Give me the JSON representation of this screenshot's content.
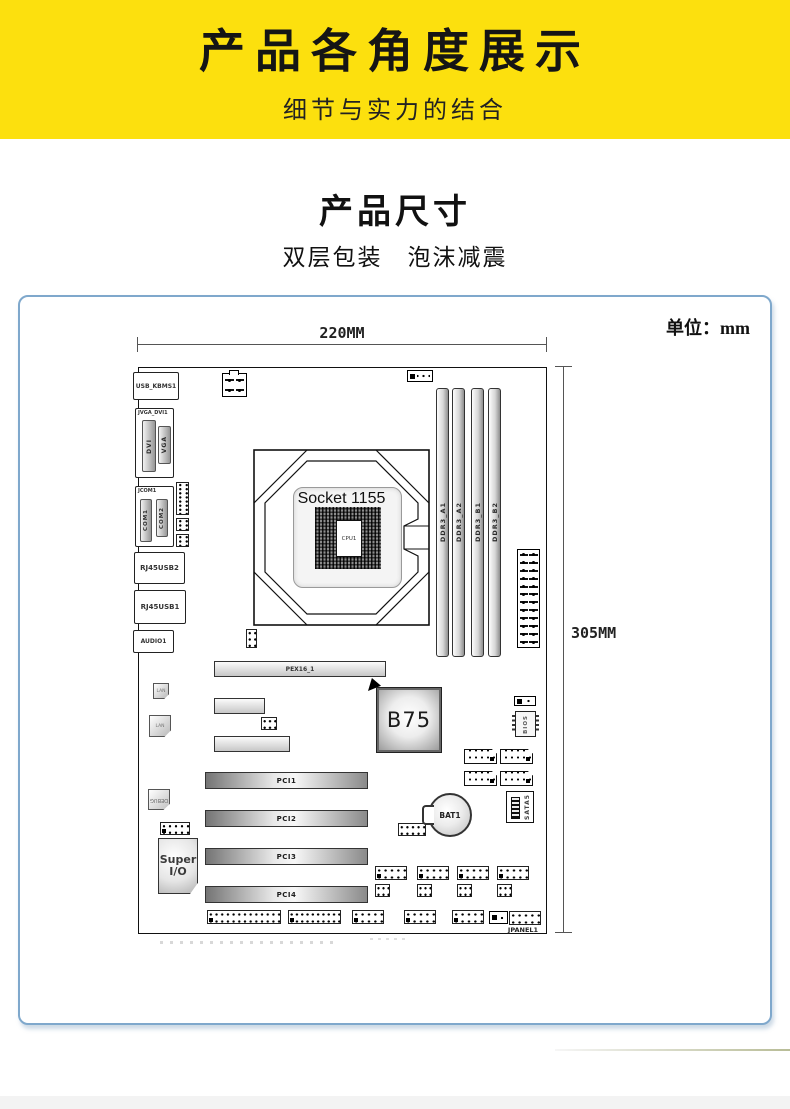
{
  "banner": {
    "title": "产品各角度展示",
    "subtitle": "细节与实力的结合",
    "bg_color": "#FCE00E"
  },
  "section": {
    "title": "产品尺寸",
    "subtitle": "双层包装　泡沫减震"
  },
  "diagram": {
    "unit_label": "单位：mm",
    "width_label": "220MM",
    "height_label": "305MM",
    "frame_border_color": "#7FA8CC",
    "socket": {
      "title": "Socket 1155",
      "cpu": "CPU1"
    }
  },
  "board": {
    "components": [
      {
        "t": "block",
        "n": "usb-kbms1-port",
        "l": "USB_KBMS1",
        "x": 133,
        "y": 372,
        "w": 46,
        "h": 28,
        "fs": 6
      },
      {
        "t": "blockTop",
        "n": "jvga-dvi1-block",
        "l": "JVGA_DVI1",
        "x": 135,
        "y": 408,
        "w": 39,
        "h": 70,
        "fs": 5
      },
      {
        "t": "gslotv",
        "n": "dvi-port",
        "l": "DVI",
        "x": 142,
        "y": 420,
        "w": 14,
        "h": 52,
        "fs": 6
      },
      {
        "t": "gslotv",
        "n": "vga-port",
        "l": "VGA",
        "x": 158,
        "y": 426,
        "w": 13,
        "h": 38,
        "fs": 6
      },
      {
        "t": "blockTop",
        "n": "jcom1-block",
        "l": "JCOM1",
        "x": 135,
        "y": 486,
        "w": 39,
        "h": 61,
        "fs": 6
      },
      {
        "t": "gslotv",
        "n": "com1-port",
        "l": "COM1",
        "x": 140,
        "y": 499,
        "w": 12,
        "h": 43,
        "fs": 5.5
      },
      {
        "t": "gslotv",
        "n": "com2-port",
        "l": "COM2",
        "x": 156,
        "y": 499,
        "w": 12,
        "h": 38,
        "fs": 5.5
      },
      {
        "t": "header",
        "n": "com-pin-header-1",
        "x": 176,
        "y": 482,
        "w": 13,
        "h": 33,
        "c": 2,
        "r": 8
      },
      {
        "t": "header",
        "n": "com-pin-header-2",
        "x": 176,
        "y": 518,
        "w": 13,
        "h": 13,
        "c": 2,
        "r": 3
      },
      {
        "t": "header",
        "n": "com-pin-header-3",
        "x": 176,
        "y": 534,
        "w": 13,
        "h": 13,
        "c": 2,
        "r": 3
      },
      {
        "t": "block",
        "n": "rj45usb2-port",
        "l": "RJ45USB2",
        "x": 134,
        "y": 552,
        "w": 51,
        "h": 32,
        "fs": 7
      },
      {
        "t": "block",
        "n": "rj45usb1-port",
        "l": "RJ45USB1",
        "x": 134,
        "y": 590,
        "w": 52,
        "h": 34,
        "fs": 7
      },
      {
        "t": "block",
        "n": "audio1-port",
        "l": "AUDIO1",
        "x": 133,
        "y": 630,
        "w": 41,
        "h": 23,
        "fs": 6
      },
      {
        "t": "power4",
        "n": "atx12v-connector",
        "x": 222,
        "y": 373,
        "w": 25,
        "h": 24
      },
      {
        "t": "fanheader",
        "n": "cpu-fan-header",
        "x": 407,
        "y": 370,
        "w": 26,
        "h": 12
      },
      {
        "t": "vslot",
        "n": "ddr3-a1-slot",
        "l": "DDR3_A1",
        "x": 436,
        "y": 388,
        "w": 13,
        "h": 269
      },
      {
        "t": "vslot",
        "n": "ddr3-a2-slot",
        "l": "DDR3_A2",
        "x": 452,
        "y": 388,
        "w": 13,
        "h": 269
      },
      {
        "t": "vslot",
        "n": "ddr3-b1-slot",
        "l": "DDR3_B1",
        "x": 471,
        "y": 388,
        "w": 13,
        "h": 269
      },
      {
        "t": "vslot",
        "n": "ddr3-b2-slot",
        "l": "DDR3_B2",
        "x": 488,
        "y": 388,
        "w": 13,
        "h": 269
      },
      {
        "t": "atx24",
        "n": "atx-24pin-connector",
        "x": 517,
        "y": 549,
        "w": 23,
        "h": 99
      },
      {
        "t": "header",
        "n": "header-under-socket",
        "x": 246,
        "y": 629,
        "w": 11,
        "h": 19,
        "c": 2,
        "r": 3
      },
      {
        "t": "hslot",
        "n": "pex16-slot",
        "l": "PEX16_1",
        "x": 214,
        "y": 661,
        "w": 172,
        "h": 16,
        "fs": 6
      },
      {
        "t": "lan",
        "n": "lan-chip-1",
        "l": "LAN",
        "x": 153,
        "y": 683,
        "w": 16,
        "h": 16
      },
      {
        "t": "lan",
        "n": "lan-chip-2",
        "l": "LAN",
        "x": 149,
        "y": 715,
        "w": 22,
        "h": 22
      },
      {
        "t": "hslot",
        "n": "pcie-x1-slot-1",
        "l": "",
        "x": 214,
        "y": 698,
        "w": 51,
        "h": 16
      },
      {
        "t": "header",
        "n": "mid-pin-header",
        "x": 261,
        "y": 717,
        "w": 16,
        "h": 13,
        "c": 3,
        "r": 2
      },
      {
        "t": "hslot",
        "n": "pcie-x1-slot-2",
        "l": "",
        "x": 214,
        "y": 736,
        "w": 76,
        "h": 16
      },
      {
        "t": "marker",
        "n": "b75-arrow-marker",
        "x": 368,
        "y": 678,
        "w": 13,
        "h": 13
      },
      {
        "t": "b75",
        "n": "b75-chipset",
        "l": "B75",
        "x": 377,
        "y": 688,
        "w": 64,
        "h": 64,
        "fs": 21
      },
      {
        "t": "fanheader",
        "n": "sys-fan-header",
        "x": 514,
        "y": 696,
        "w": 22,
        "h": 10
      },
      {
        "t": "bios",
        "n": "bios-chip",
        "l": "BIOS",
        "x": 515,
        "y": 711,
        "w": 21,
        "h": 26
      },
      {
        "t": "sata",
        "n": "sata-port-1",
        "x": 464,
        "y": 749,
        "w": 33,
        "h": 15
      },
      {
        "t": "sata",
        "n": "sata-port-2",
        "x": 500,
        "y": 749,
        "w": 33,
        "h": 15
      },
      {
        "t": "sata",
        "n": "sata-port-3",
        "x": 464,
        "y": 771,
        "w": 33,
        "h": 15
      },
      {
        "t": "sata",
        "n": "sata-port-4",
        "x": 500,
        "y": 771,
        "w": 33,
        "h": 15
      },
      {
        "t": "pci",
        "n": "pci1-slot",
        "l": "PCI1",
        "x": 205,
        "y": 772,
        "w": 163,
        "h": 17,
        "fs": 7
      },
      {
        "t": "debug",
        "n": "debug-chip",
        "l": "DEBUG",
        "x": 148,
        "y": 789,
        "w": 22,
        "h": 21
      },
      {
        "t": "pci",
        "n": "pci2-slot",
        "l": "PCI2",
        "x": 205,
        "y": 810,
        "w": 163,
        "h": 17,
        "fs": 7
      },
      {
        "t": "header",
        "n": "left-pin-header",
        "x": 160,
        "y": 822,
        "w": 30,
        "h": 13,
        "c": 5,
        "r": 2,
        "p1": true
      },
      {
        "t": "header",
        "n": "bat-pin-header",
        "x": 398,
        "y": 823,
        "w": 28,
        "h": 13,
        "c": 5,
        "r": 2
      },
      {
        "t": "battery",
        "n": "bat1-battery",
        "l": "BAT1",
        "x": 428,
        "y": 793,
        "w": 44,
        "h": 44,
        "fs": 7.5
      },
      {
        "t": "sata5",
        "n": "sata5-port",
        "l": "SATA5",
        "x": 506,
        "y": 791,
        "w": 28,
        "h": 32
      },
      {
        "t": "superio",
        "n": "super-io-chip",
        "l": "Super I/O",
        "x": 158,
        "y": 838,
        "w": 40,
        "h": 56,
        "fs": 11
      },
      {
        "t": "pci",
        "n": "pci3-slot",
        "l": "PCI3",
        "x": 205,
        "y": 848,
        "w": 163,
        "h": 17,
        "fs": 7
      },
      {
        "t": "pci",
        "n": "pci4-slot",
        "l": "PCI4",
        "x": 205,
        "y": 886,
        "w": 163,
        "h": 17,
        "fs": 7
      },
      {
        "t": "header",
        "n": "usb-header-1",
        "x": 375,
        "y": 866,
        "w": 32,
        "h": 14,
        "c": 5,
        "r": 2,
        "p1": true
      },
      {
        "t": "header",
        "n": "usb-header-2",
        "x": 417,
        "y": 866,
        "w": 32,
        "h": 14,
        "c": 5,
        "r": 2,
        "p1": true
      },
      {
        "t": "header",
        "n": "usb-header-3",
        "x": 457,
        "y": 866,
        "w": 32,
        "h": 14,
        "c": 5,
        "r": 2,
        "p1": true
      },
      {
        "t": "header",
        "n": "usb-header-4",
        "x": 497,
        "y": 866,
        "w": 32,
        "h": 14,
        "c": 5,
        "r": 2,
        "p1": true
      },
      {
        "t": "header",
        "n": "jumper-header-1",
        "x": 375,
        "y": 884,
        "w": 15,
        "h": 13,
        "c": 3,
        "r": 2
      },
      {
        "t": "header",
        "n": "jumper-header-2",
        "x": 417,
        "y": 884,
        "w": 15,
        "h": 13,
        "c": 3,
        "r": 2
      },
      {
        "t": "header",
        "n": "jumper-header-3",
        "x": 457,
        "y": 884,
        "w": 15,
        "h": 13,
        "c": 3,
        "r": 2
      },
      {
        "t": "header",
        "n": "jumper-header-4",
        "x": 497,
        "y": 884,
        "w": 15,
        "h": 13,
        "c": 3,
        "r": 2
      },
      {
        "t": "header",
        "n": "bottom-header-1",
        "x": 207,
        "y": 910,
        "w": 74,
        "h": 14,
        "c": 13,
        "r": 2,
        "p1": true
      },
      {
        "t": "header",
        "n": "bottom-header-2",
        "x": 288,
        "y": 910,
        "w": 53,
        "h": 14,
        "c": 10,
        "r": 2,
        "p1": true
      },
      {
        "t": "header",
        "n": "bottom-header-3",
        "x": 352,
        "y": 910,
        "w": 32,
        "h": 14,
        "c": 5,
        "r": 2,
        "p1": true
      },
      {
        "t": "header",
        "n": "bottom-header-4",
        "x": 404,
        "y": 910,
        "w": 32,
        "h": 14,
        "c": 5,
        "r": 2,
        "p1": true
      },
      {
        "t": "header",
        "n": "bottom-header-5",
        "x": 452,
        "y": 910,
        "w": 32,
        "h": 14,
        "c": 5,
        "r": 2,
        "p1": true
      },
      {
        "t": "fanheader",
        "n": "bottom-3pin-connector",
        "x": 489,
        "y": 911,
        "w": 19,
        "h": 13
      },
      {
        "t": "header",
        "n": "jpanel1-header",
        "x": 509,
        "y": 911,
        "w": 32,
        "h": 14,
        "c": 5,
        "r": 2
      },
      {
        "t": "label",
        "n": "jpanel1-label",
        "l": "JPANEL1",
        "x": 502,
        "y": 925,
        "w": 42,
        "h": 10,
        "fs": 6.5
      }
    ]
  }
}
